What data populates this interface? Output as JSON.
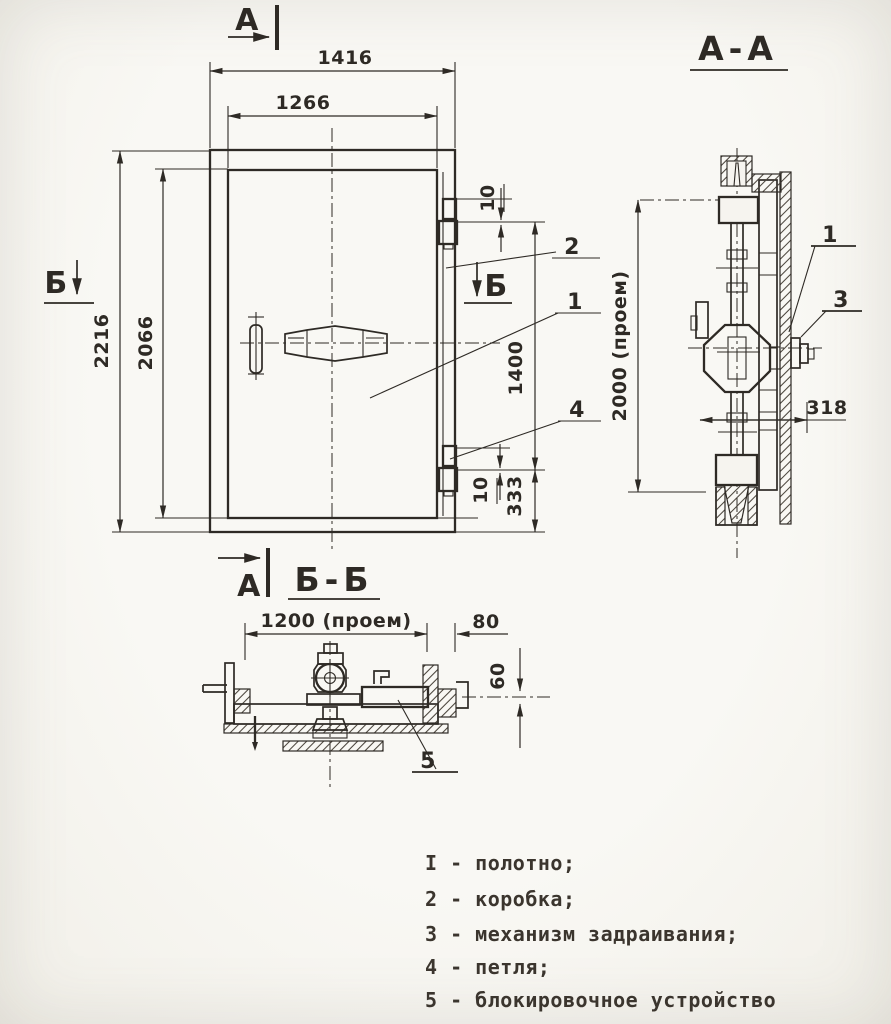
{
  "colors": {
    "paper": "#f6f4ef",
    "ink": "#2e2a25",
    "ink_soft": "#4a443c"
  },
  "front_view": {
    "marker_a_top": "А",
    "marker_a_bottom": "А",
    "marker_b_left": "Б",
    "marker_b_right": "Б",
    "dim_frame_width": "1416",
    "dim_leaf_width": "1266",
    "dim_frame_height": "2216",
    "dim_leaf_height": "2066",
    "dim_hinge_top_gap": "10",
    "dim_hinge_span": "1400",
    "dim_hinge_bottom_gap": "10",
    "dim_hinge_bottom_offset": "333",
    "callout_leaf": "1",
    "callout_frame": "2",
    "callout_hinge": "4"
  },
  "section_aa": {
    "title": "А-А",
    "dim_opening_height": "2000 (проем)",
    "dim_depth": "318",
    "callout_leaf": "1",
    "callout_mechanism": "3"
  },
  "section_bb": {
    "title": "Б-Б",
    "dim_opening_width": "1200 (проем)",
    "dim_frame_offset": "80",
    "dim_leaf_thickness": "60",
    "callout_lock": "5"
  },
  "legend": {
    "items": [
      "I - полотно;",
      "2 - коробка;",
      "3 - механизм задраивания;",
      "4 - петля;",
      "5 - блокировочное устройство"
    ]
  }
}
